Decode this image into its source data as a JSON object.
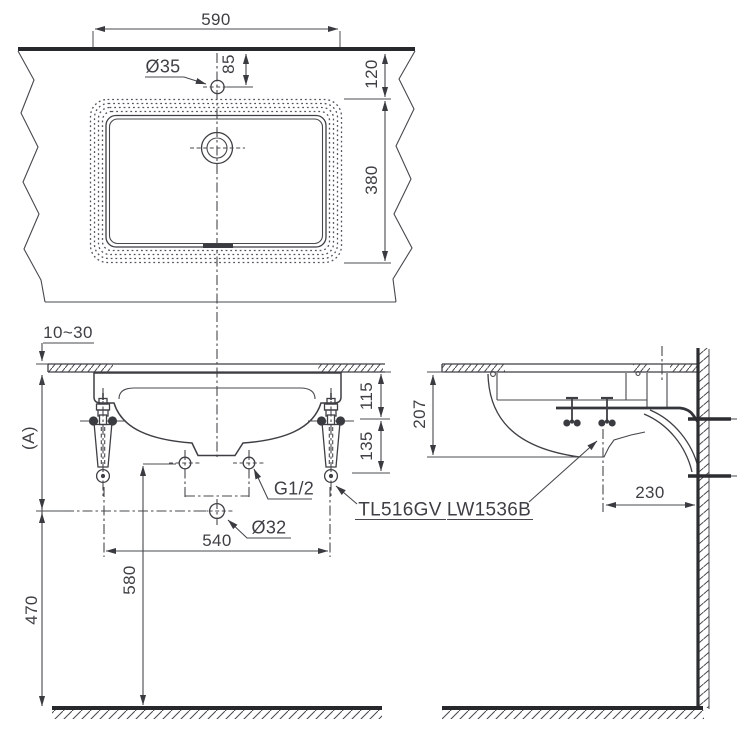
{
  "plan_view": {
    "width_dim": "590",
    "faucet_hole_label": "Ø35",
    "faucet_offset_dim": "85",
    "front_edge_dim": "120",
    "basin_depth_dim": "380"
  },
  "front_view": {
    "counter_thickness_dim": "10~30",
    "counter_height_dim": "(A)",
    "rim_drop_dim": "115",
    "hanger_dim": "135",
    "supply_thread_label": "G1/2",
    "faucet_model": "TL516GV",
    "bolt_spacing_dim": "540",
    "drain_hole_label": "Ø32",
    "supply_height_dim": "580",
    "drain_height_dim": "470"
  },
  "side_view": {
    "basin_drop_dim": "207",
    "drain_wall_offset_dim": "230",
    "basin_model": "LW1536B"
  }
}
